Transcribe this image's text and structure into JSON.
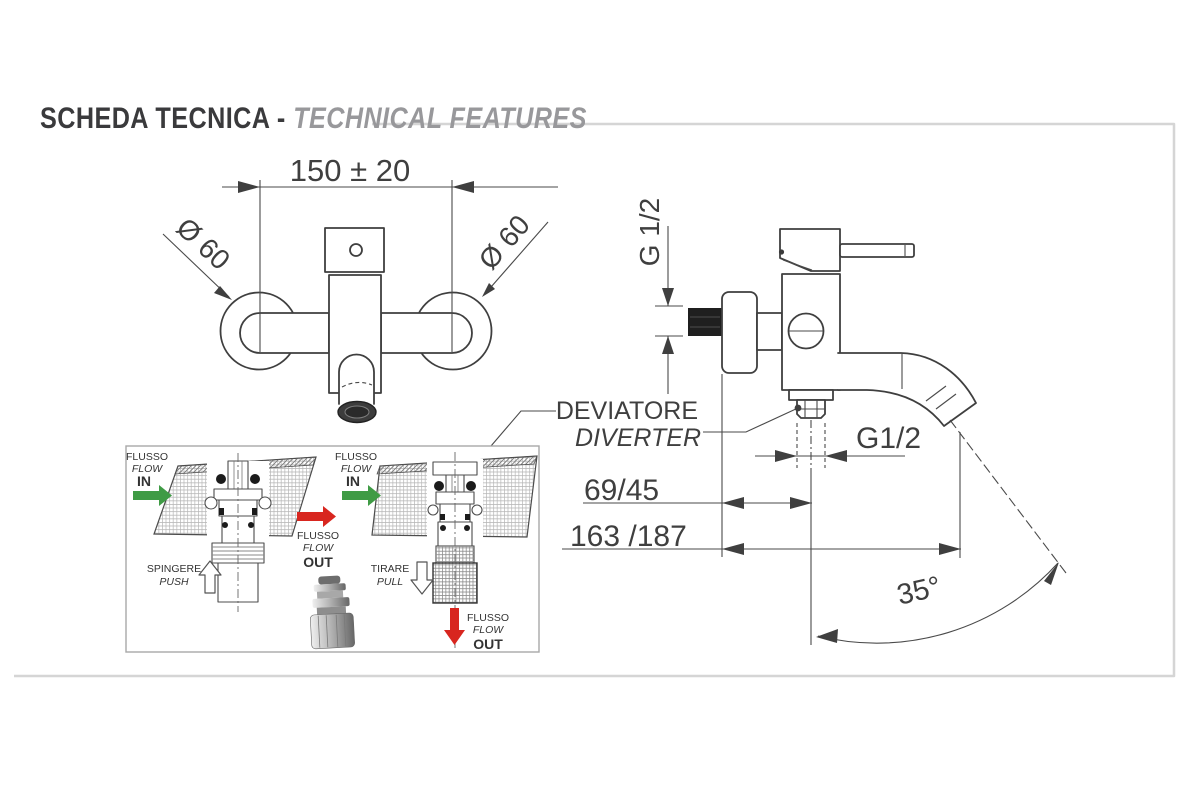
{
  "header": {
    "title_primary": "SCHEDA TECNICA -",
    "title_secondary": "TECHNICAL FEATURES"
  },
  "front_view": {
    "center_distance": "150 ± 20",
    "left_escutcheon_diameter": "Ø 60",
    "right_escutcheon_diameter": "Ø 60"
  },
  "side_view": {
    "inlet_thread": "G 1/2",
    "outlet_thread": "G1/2",
    "diverter_label_italian": "DEVIATORE",
    "diverter_label_english": "DIVERTER",
    "wall_to_diverter_outlet": "69/45",
    "wall_to_spout_tip": "163 /187",
    "spout_angle": "35°"
  },
  "diverter_inset": {
    "push_diagram": {
      "inlet": [
        "FLUSSO",
        "FLOW",
        "IN"
      ],
      "outlet": [
        "FLUSSO",
        "FLOW",
        "OUT"
      ],
      "action": [
        "SPINGERE",
        "PUSH"
      ]
    },
    "pull_diagram": {
      "inlet": [
        "FLUSSO",
        "FLOW",
        "IN"
      ],
      "outlet": [
        "FLUSSO",
        "FLOW",
        "OUT"
      ],
      "action": [
        "TIRARE",
        "PULL"
      ]
    }
  },
  "colors": {
    "flow_in_arrow": "#3f9b45",
    "flow_out_arrow": "#d8261f",
    "drawing_line": "#3f3f3f",
    "frame_border": "#d5d5d5"
  }
}
